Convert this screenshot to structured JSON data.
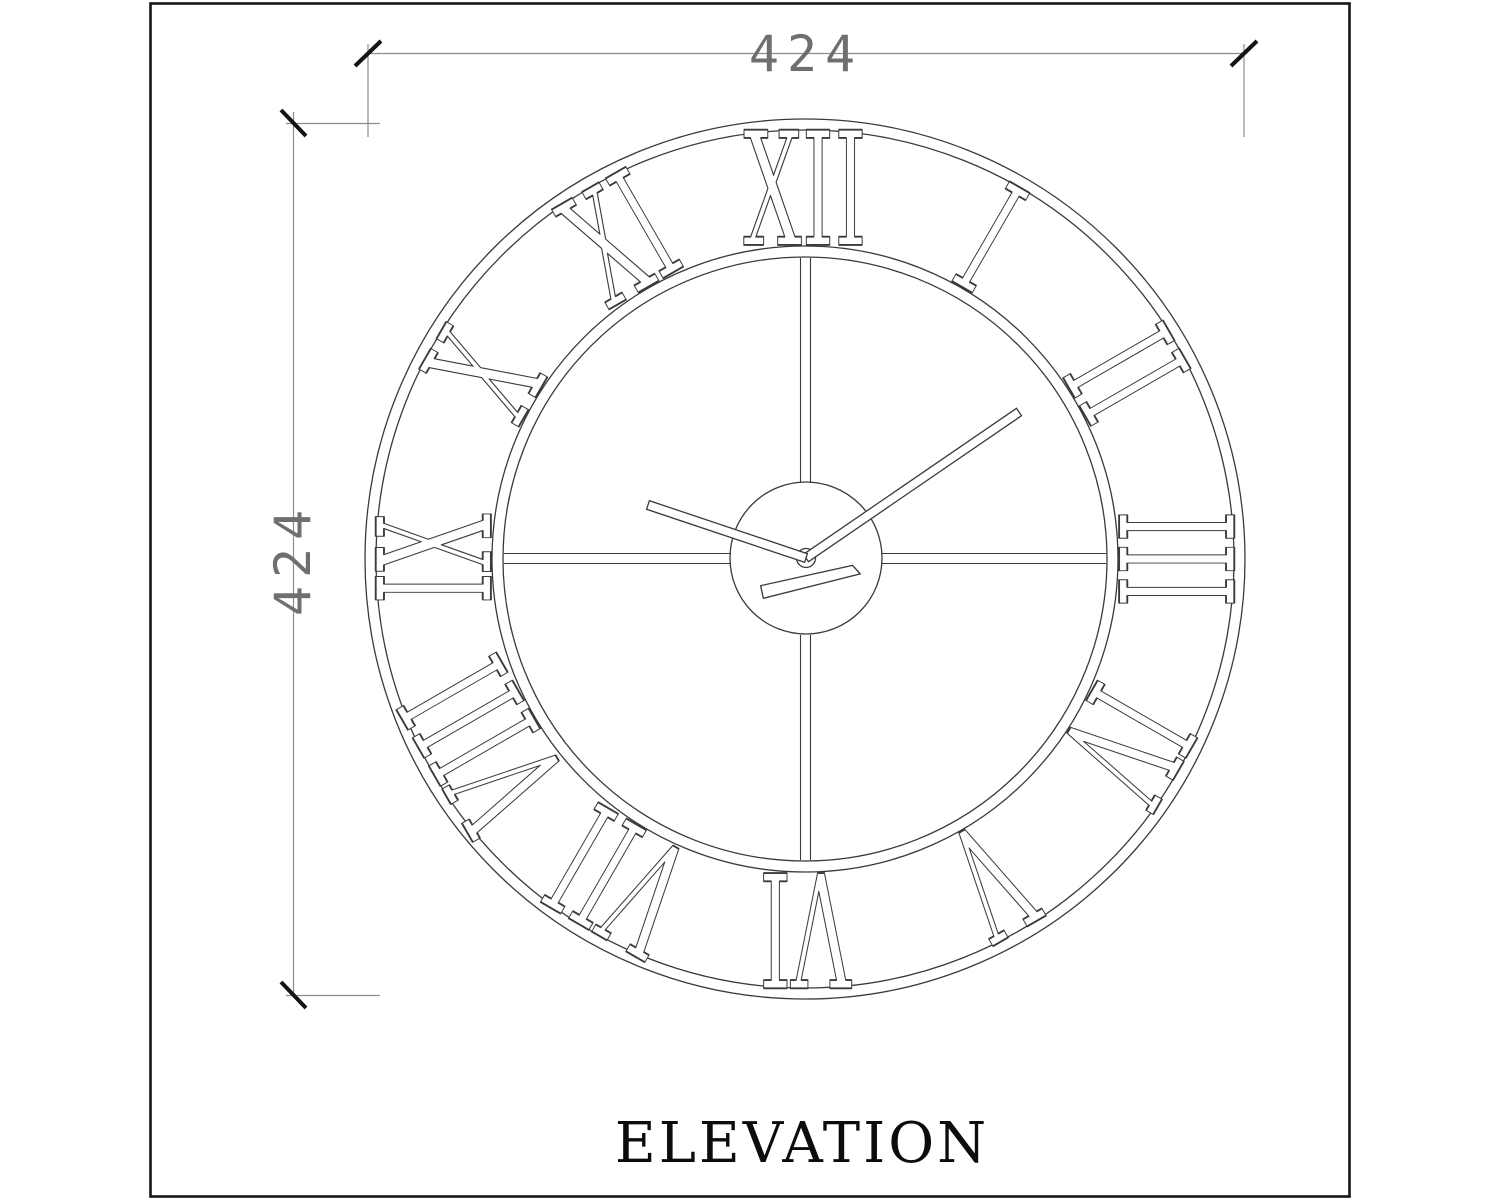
{
  "page": {
    "background": "#ffffff",
    "kind": "CAD elevation drawing of a skeleton wall clock"
  },
  "title_block": {
    "label": "ELEVATION"
  },
  "dimensions": {
    "width": {
      "value": "424",
      "orientation": "horizontal",
      "position": "top"
    },
    "height": {
      "value": "424",
      "orientation": "vertical",
      "position": "left"
    }
  },
  "drawing": {
    "type": "wall-clock-elevation",
    "clock": {
      "numerals": [
        "I",
        "II",
        "III",
        "IV",
        "V",
        "VI",
        "VII",
        "VIII",
        "IX",
        "X",
        "XI",
        "XII"
      ],
      "numeral_style": "roman, radially oriented, outlined",
      "hands": [
        "hour",
        "minute",
        "second"
      ],
      "features": [
        "outer double rim",
        "inner double ring",
        "quadrant cross bars",
        "center hub",
        "pivot"
      ]
    },
    "colors": {
      "drawing_line": "#3a3a3a",
      "dimension_line": "#8c8c8c",
      "dimension_text": "#6f6f6f",
      "tick": "#141414",
      "border": "#151515",
      "title": "#0c0c0c"
    }
  }
}
